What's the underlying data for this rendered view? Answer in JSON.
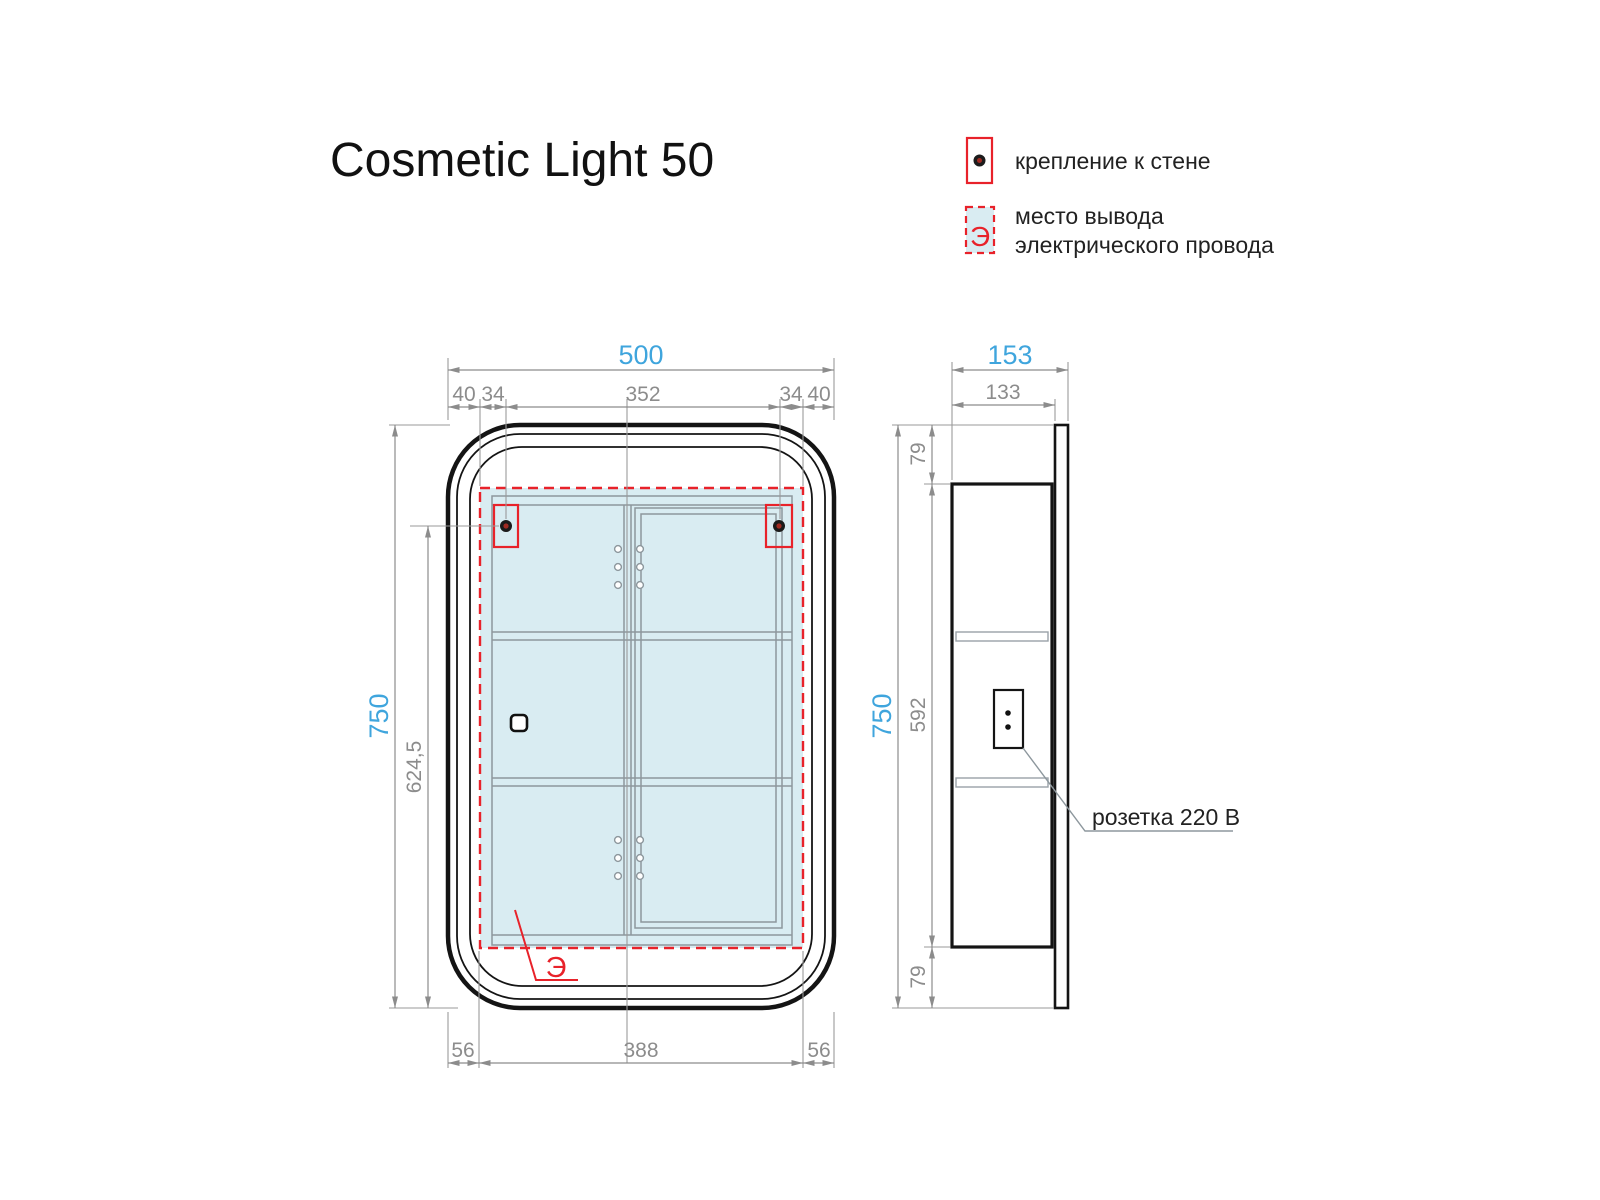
{
  "title": "Cosmetic Light 50",
  "legend": {
    "mount": {
      "label": "крепление к стене"
    },
    "wire": {
      "symbol": "Э",
      "label_line1": "место вывода",
      "label_line2": "электрического провода"
    }
  },
  "front_view": {
    "dim_width_total": "500",
    "dim_top_chain": [
      "40",
      "34",
      "352",
      "34",
      "40"
    ],
    "dim_height_total": "750",
    "dim_mount_to_bottom": "624,5",
    "dim_bottom_chain": [
      "56",
      "388",
      "56"
    ],
    "wire_symbol": "Э"
  },
  "side_view": {
    "dim_depth_total": "153",
    "dim_depth_inner": "133",
    "dim_height_total": "750",
    "dim_side_chain": [
      "79",
      "592",
      "79"
    ],
    "socket_label": "розетка 220 В"
  },
  "colors": {
    "accent_blue": "#3fa5dd",
    "dim_gray": "#8c8c8c",
    "marker_red": "#e8222a",
    "panel_blue": "#d9ecf2"
  }
}
